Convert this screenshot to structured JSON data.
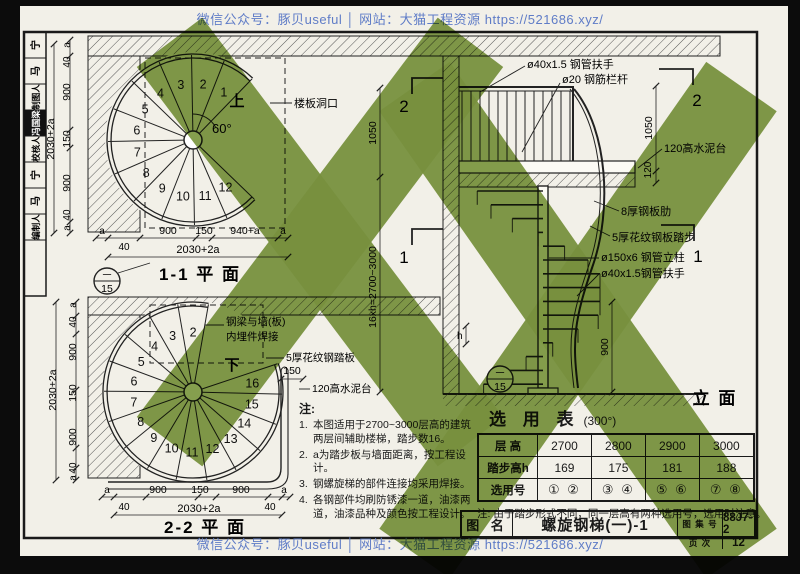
{
  "banner": {
    "top": "微信公众号：豚贝useful │ 网站：大猫工程资源 https://521686.xyz/",
    "bottom": "微信公众号：豚贝useful │ 网站：大猫工程资源 https://521686.xyz/"
  },
  "sidebar": {
    "cells": [
      {
        "label": "宁",
        "inverted": false
      },
      {
        "label": "马",
        "inverted": false
      },
      {
        "label": "制图人",
        "inverted": false
      },
      {
        "label": "冯国梁",
        "inverted": true
      },
      {
        "label": "校核人",
        "inverted": false
      },
      {
        "label": "宁",
        "inverted": false
      },
      {
        "label": "马",
        "inverted": false
      },
      {
        "label": "编制人",
        "inverted": false
      }
    ]
  },
  "plan_top": {
    "title": "1-1 平  面",
    "detail_circle": {
      "top": "一",
      "bottom": "15"
    },
    "up_label": "上",
    "angle": "60°",
    "opening_label": "楼板洞口",
    "steps": [
      "1",
      "2",
      "3",
      "4",
      "5",
      "6",
      "7",
      "8",
      "9",
      "10",
      "11",
      "12"
    ],
    "dims_left": [
      "a",
      "40",
      "900",
      "150",
      "900",
      "40",
      "a"
    ],
    "dim_left_total": "2030+2a",
    "dims_bottom": [
      "a",
      "40",
      "900",
      "150",
      "940+a",
      "a"
    ],
    "dim_bottom_total": "2030+2a"
  },
  "plan_bottom": {
    "title": "2-2 平  面",
    "down_label": "下",
    "steps": [
      "2",
      "3",
      "4",
      "5",
      "6",
      "7",
      "8",
      "9",
      "10",
      "11",
      "12",
      "13",
      "14",
      "15",
      "16"
    ],
    "labels": {
      "weld1": "钢梁与墙(板)",
      "weld2": "内埋件焊接",
      "tread": "5厚花纹钢踏板",
      "dim150": "150",
      "curb": "120高水泥台"
    },
    "dims_left": [
      "a",
      "40",
      "900",
      "150",
      "900",
      "40",
      "a"
    ],
    "dim_left_total": "2030+2a",
    "dims_bottom": [
      "a",
      "40",
      "900",
      "150",
      "900",
      "40",
      "a"
    ],
    "dim_bottom_total": "2030+2a"
  },
  "elevation": {
    "title": "立  面",
    "section_mark_2": "2",
    "section_mark_1": "1",
    "detail_circle": {
      "top": "一",
      "bottom": "15"
    },
    "labels": {
      "handrail_top": "ø40x1.5 钢管扶手",
      "railing": "ø20 钢筋栏杆",
      "curb": "120高水泥台",
      "rib": "8厚钢板肋",
      "tread": "5厚花纹钢板踏步",
      "column": "ø150x6 钢管立柱",
      "handrail": "ø40x1.5钢管扶手",
      "h": "h"
    },
    "dims": {
      "rail_height": "1050",
      "curb": "120",
      "landing": "900",
      "mid_top": "1050",
      "floor": "16xh=2700~3000"
    }
  },
  "notes": {
    "heading": "注:",
    "items": [
      {
        "no": "1.",
        "text": "本图适用于2700~3000层高的建筑两层间辅助楼梯，踏步数16。"
      },
      {
        "no": "2.",
        "text": "a为踏步板与墙面距离，按工程设计。"
      },
      {
        "no": "3.",
        "text": "钢螺旋梯的部件连接均采用焊接。"
      },
      {
        "no": "4.",
        "text": "各钢部件均刷防锈漆一道，油漆两道，油漆品种及颜色按工程设计。"
      }
    ]
  },
  "selection": {
    "title": "选 用 表",
    "angle": "(300°)",
    "table": {
      "rows": [
        [
          "层  高",
          "2700",
          "2800",
          "2900",
          "3000"
        ],
        [
          "踏步高h",
          "169",
          "175",
          "181",
          "188"
        ],
        [
          "选用号",
          "① ②",
          "③ ④",
          "⑤ ⑥",
          "⑦ ⑧"
        ]
      ]
    },
    "note": "注: 由于踏步形式不同，同一层高有两种选用号，选用时注意。"
  },
  "titleblock": {
    "name_label": "图 名",
    "name": "螺旋钢梯(一)-1",
    "atlas_label": "图 集 号",
    "atlas_no": "88J7-2",
    "page_label": "页 次",
    "page_no": "12"
  },
  "colors": {
    "paper": "#f2f0e8",
    "ink": "#1a1a1a",
    "watermark_green": "#7e9a44",
    "banner_blue": "#5f7cc7"
  }
}
